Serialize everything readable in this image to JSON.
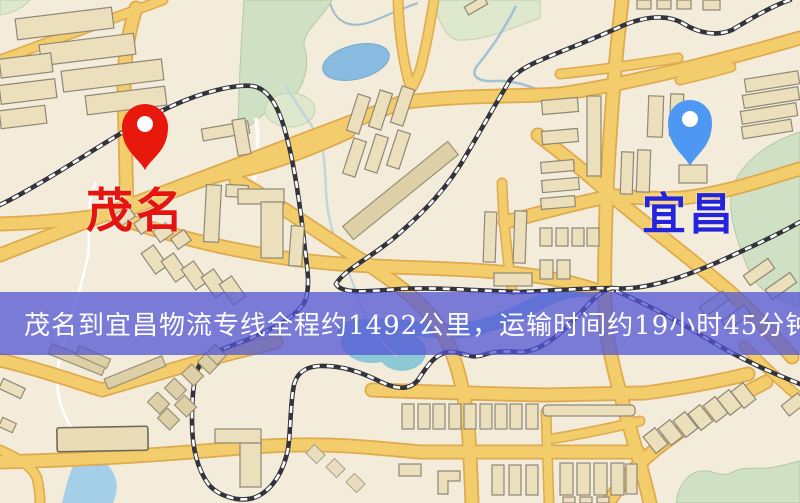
{
  "banner": {
    "text": "茂名到宜昌物流专线全程约1492公里，运输时间约19小时45分钟.",
    "background": "rgba(82,86,213,0.75)",
    "text_color": "#ffffff"
  },
  "origin": {
    "label": "茂名",
    "pin_color": "#e8180c",
    "pin_hole_color": "#ffffff",
    "label_color": "#e51410"
  },
  "destination": {
    "label": "宜昌",
    "pin_color": "#4e97f2",
    "pin_hole_color": "#ffffff",
    "label_color": "#2424dd"
  },
  "map": {
    "colors": {
      "background": "#f3ecda",
      "road": "#f3cd6b",
      "road_casing": "#dfa94e",
      "railway": "#33333b",
      "park": "#cfe0c4",
      "water": "#a5cfe9",
      "building": "#ecdfbc"
    }
  }
}
